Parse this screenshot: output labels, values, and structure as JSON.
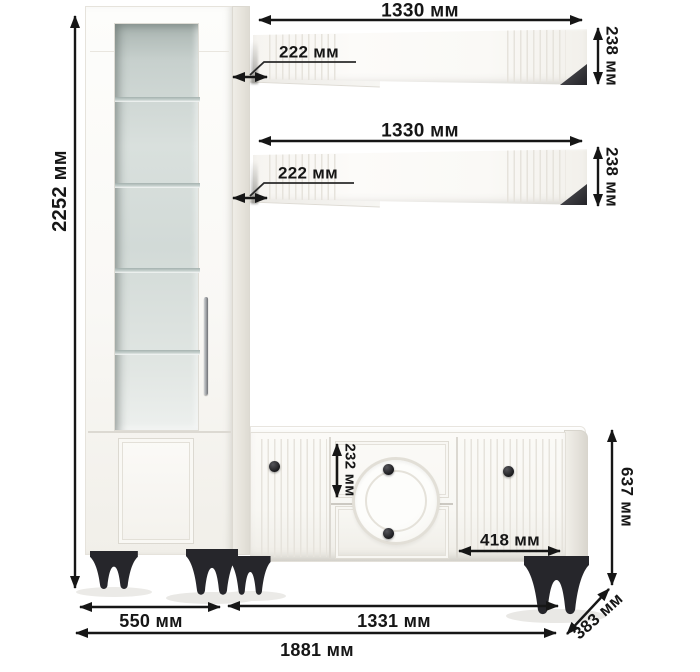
{
  "cabinet": {
    "height_label": "2252 мм",
    "width_label": "550 мм"
  },
  "shelf_top": {
    "width_label": "1330 мм",
    "height_label": "238 мм",
    "depth_label": "222 мм"
  },
  "shelf_bottom": {
    "width_label": "1330 мм",
    "height_label": "238 мм",
    "depth_label": "222 мм"
  },
  "tv_stand": {
    "width_label": "1331 мм",
    "height_label": "637 мм",
    "drawer_height_label": "232 мм",
    "door_width_label": "418 мм"
  },
  "overall": {
    "width_label": "1881 мм",
    "depth_label": "383 мм"
  },
  "colors": {
    "dimension_ink": "#161616",
    "furniture_white": "#f8f7f3",
    "furniture_shade": "#e7e4dd",
    "glass_green": "#cdd6d3",
    "legs_black": "#26262b",
    "background": "#ffffff"
  }
}
